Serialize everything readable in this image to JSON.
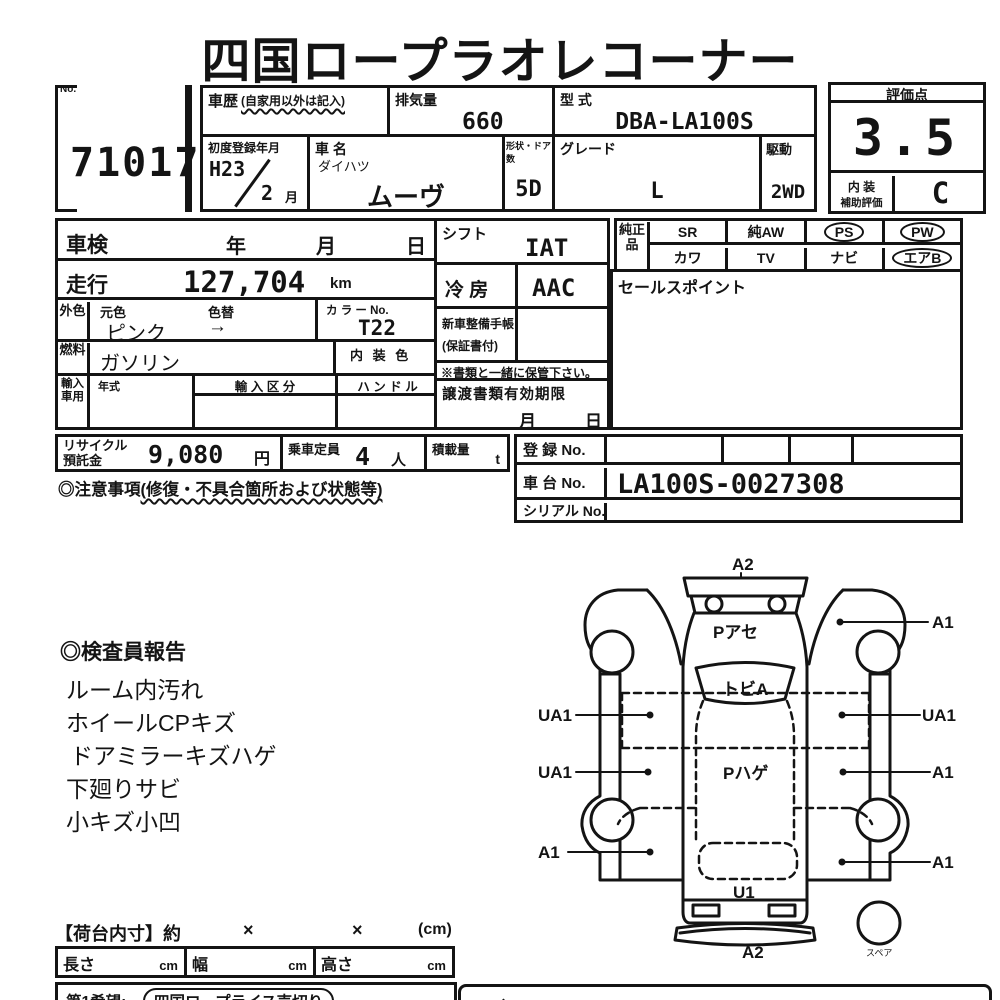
{
  "title": "四国ロープラオレコーナー",
  "lot": {
    "no_label": "No.",
    "number": "71017"
  },
  "header": {
    "history_label": "車歴",
    "history_note": "(自家用以外は記入)",
    "displacement_label": "排気量",
    "displacement_value": "660",
    "model_code_label": "型 式",
    "model_code_value": "DBA-LA100S",
    "first_reg_label": "初度登録年月",
    "first_reg_year": "H23",
    "first_reg_month": "2",
    "first_reg_month_suffix": "月",
    "car_name_label": "車 名",
    "maker_name": "ダイハツ",
    "car_name_value": "ムーヴ",
    "body_doors_label": "形状・ドア数",
    "body_doors_value": "5D",
    "grade_label": "グレード",
    "grade_value": "L",
    "drive_label": "駆動",
    "drive_value": "2WD"
  },
  "rating": {
    "label": "評価点",
    "score": "3.5",
    "interior_label_line1": "内 装",
    "interior_label_line2": "補助評価",
    "interior_grade": "C"
  },
  "inspection": {
    "label": "車検",
    "year_suffix": "年",
    "month_suffix": "月",
    "day_suffix": "日"
  },
  "mileage": {
    "label": "走行",
    "value": "127,704",
    "unit": "km"
  },
  "color": {
    "side_label": "外色",
    "original_label": "元色",
    "change_label": "色替",
    "value": "ピンク",
    "arrow": "→",
    "color_no_label": "カ ラ ー No.",
    "color_no_value": "T22"
  },
  "fuel": {
    "side_label": "燃料",
    "value": "ガソリン",
    "interior_color_label": "内 装 色"
  },
  "import": {
    "side_label": "輸入車用",
    "year_type_label": "年式",
    "import_class_label": "輸 入 区 分",
    "handle_label": "ハ ン ド ル"
  },
  "shift": {
    "label": "シフト",
    "value": "IAT"
  },
  "aircon": {
    "label": "冷  房",
    "value": "AAC"
  },
  "service_book": {
    "label": "新車整備手帳",
    "note": "(保証書付)",
    "keep_note": "※書類と一緒に保管下さい。"
  },
  "transfer_docs": {
    "label": "譲渡書類有効期限",
    "month_suffix": "月",
    "day_suffix": "日"
  },
  "genuine_parts": {
    "side_label": "純正品",
    "items": [
      {
        "label": "SR",
        "circled": false
      },
      {
        "label": "純AW",
        "circled": false
      },
      {
        "label": "PS",
        "circled": true
      },
      {
        "label": "PW",
        "circled": true
      },
      {
        "label": "カワ",
        "circled": false
      },
      {
        "label": "TV",
        "circled": false
      },
      {
        "label": "ナビ",
        "circled": false
      },
      {
        "label": "エアB",
        "circled": true
      }
    ]
  },
  "sales_point": {
    "label": "セールスポイント"
  },
  "recycle": {
    "label_line1": "リサイクル",
    "label_line2": "預託金",
    "value": "9,080",
    "unit": "円"
  },
  "capacity": {
    "label": "乗車定員",
    "value": "4",
    "unit": "人"
  },
  "load": {
    "label": "積載量",
    "unit": "t"
  },
  "caution": {
    "prefix": "◎注意事項",
    "note": "(修復・不具合箇所および状態等)"
  },
  "registration": {
    "reg_no_label": "登  録 No.",
    "chassis_no_label": "車  台 No.",
    "chassis_no_value": "LA100S-0027308",
    "serial_no_label": "シリアル No."
  },
  "inspector_report": {
    "title": "◎検査員報告",
    "items": [
      "ルーム内汚れ",
      "ホイールCPキズ",
      "ドアミラーキズハゲ",
      "下廻りサビ",
      "小キズ小凹"
    ]
  },
  "diagram": {
    "a2_top": "A2",
    "p_ase": "Pアセ",
    "a1_top_right": "A1",
    "tobi_a": "トビA",
    "ua1_left_upper": "UA1",
    "ua1_right": "UA1",
    "ua1_left_lower": "UA1",
    "p_hage": "Pハゲ",
    "a1_right_mid": "A1",
    "a1_left_bottom": "A1",
    "a1_right_bottom": "A1",
    "u1": "U1",
    "a2_bottom": "A2",
    "spare_label": "スペア"
  },
  "cargo_dims": {
    "title": "【荷台内寸】約",
    "times1": "×",
    "times2": "×",
    "unit": "(cm)",
    "length_label": "長さ",
    "length_unit": "cm",
    "width_label": "幅",
    "width_unit": "cm",
    "height_label": "高さ",
    "height_unit": "cm"
  },
  "bottom": {
    "first_wish_label": "第1希望:",
    "first_wish_value": "四国ロープライス売切り",
    "right_box_fragment": "◆日"
  }
}
